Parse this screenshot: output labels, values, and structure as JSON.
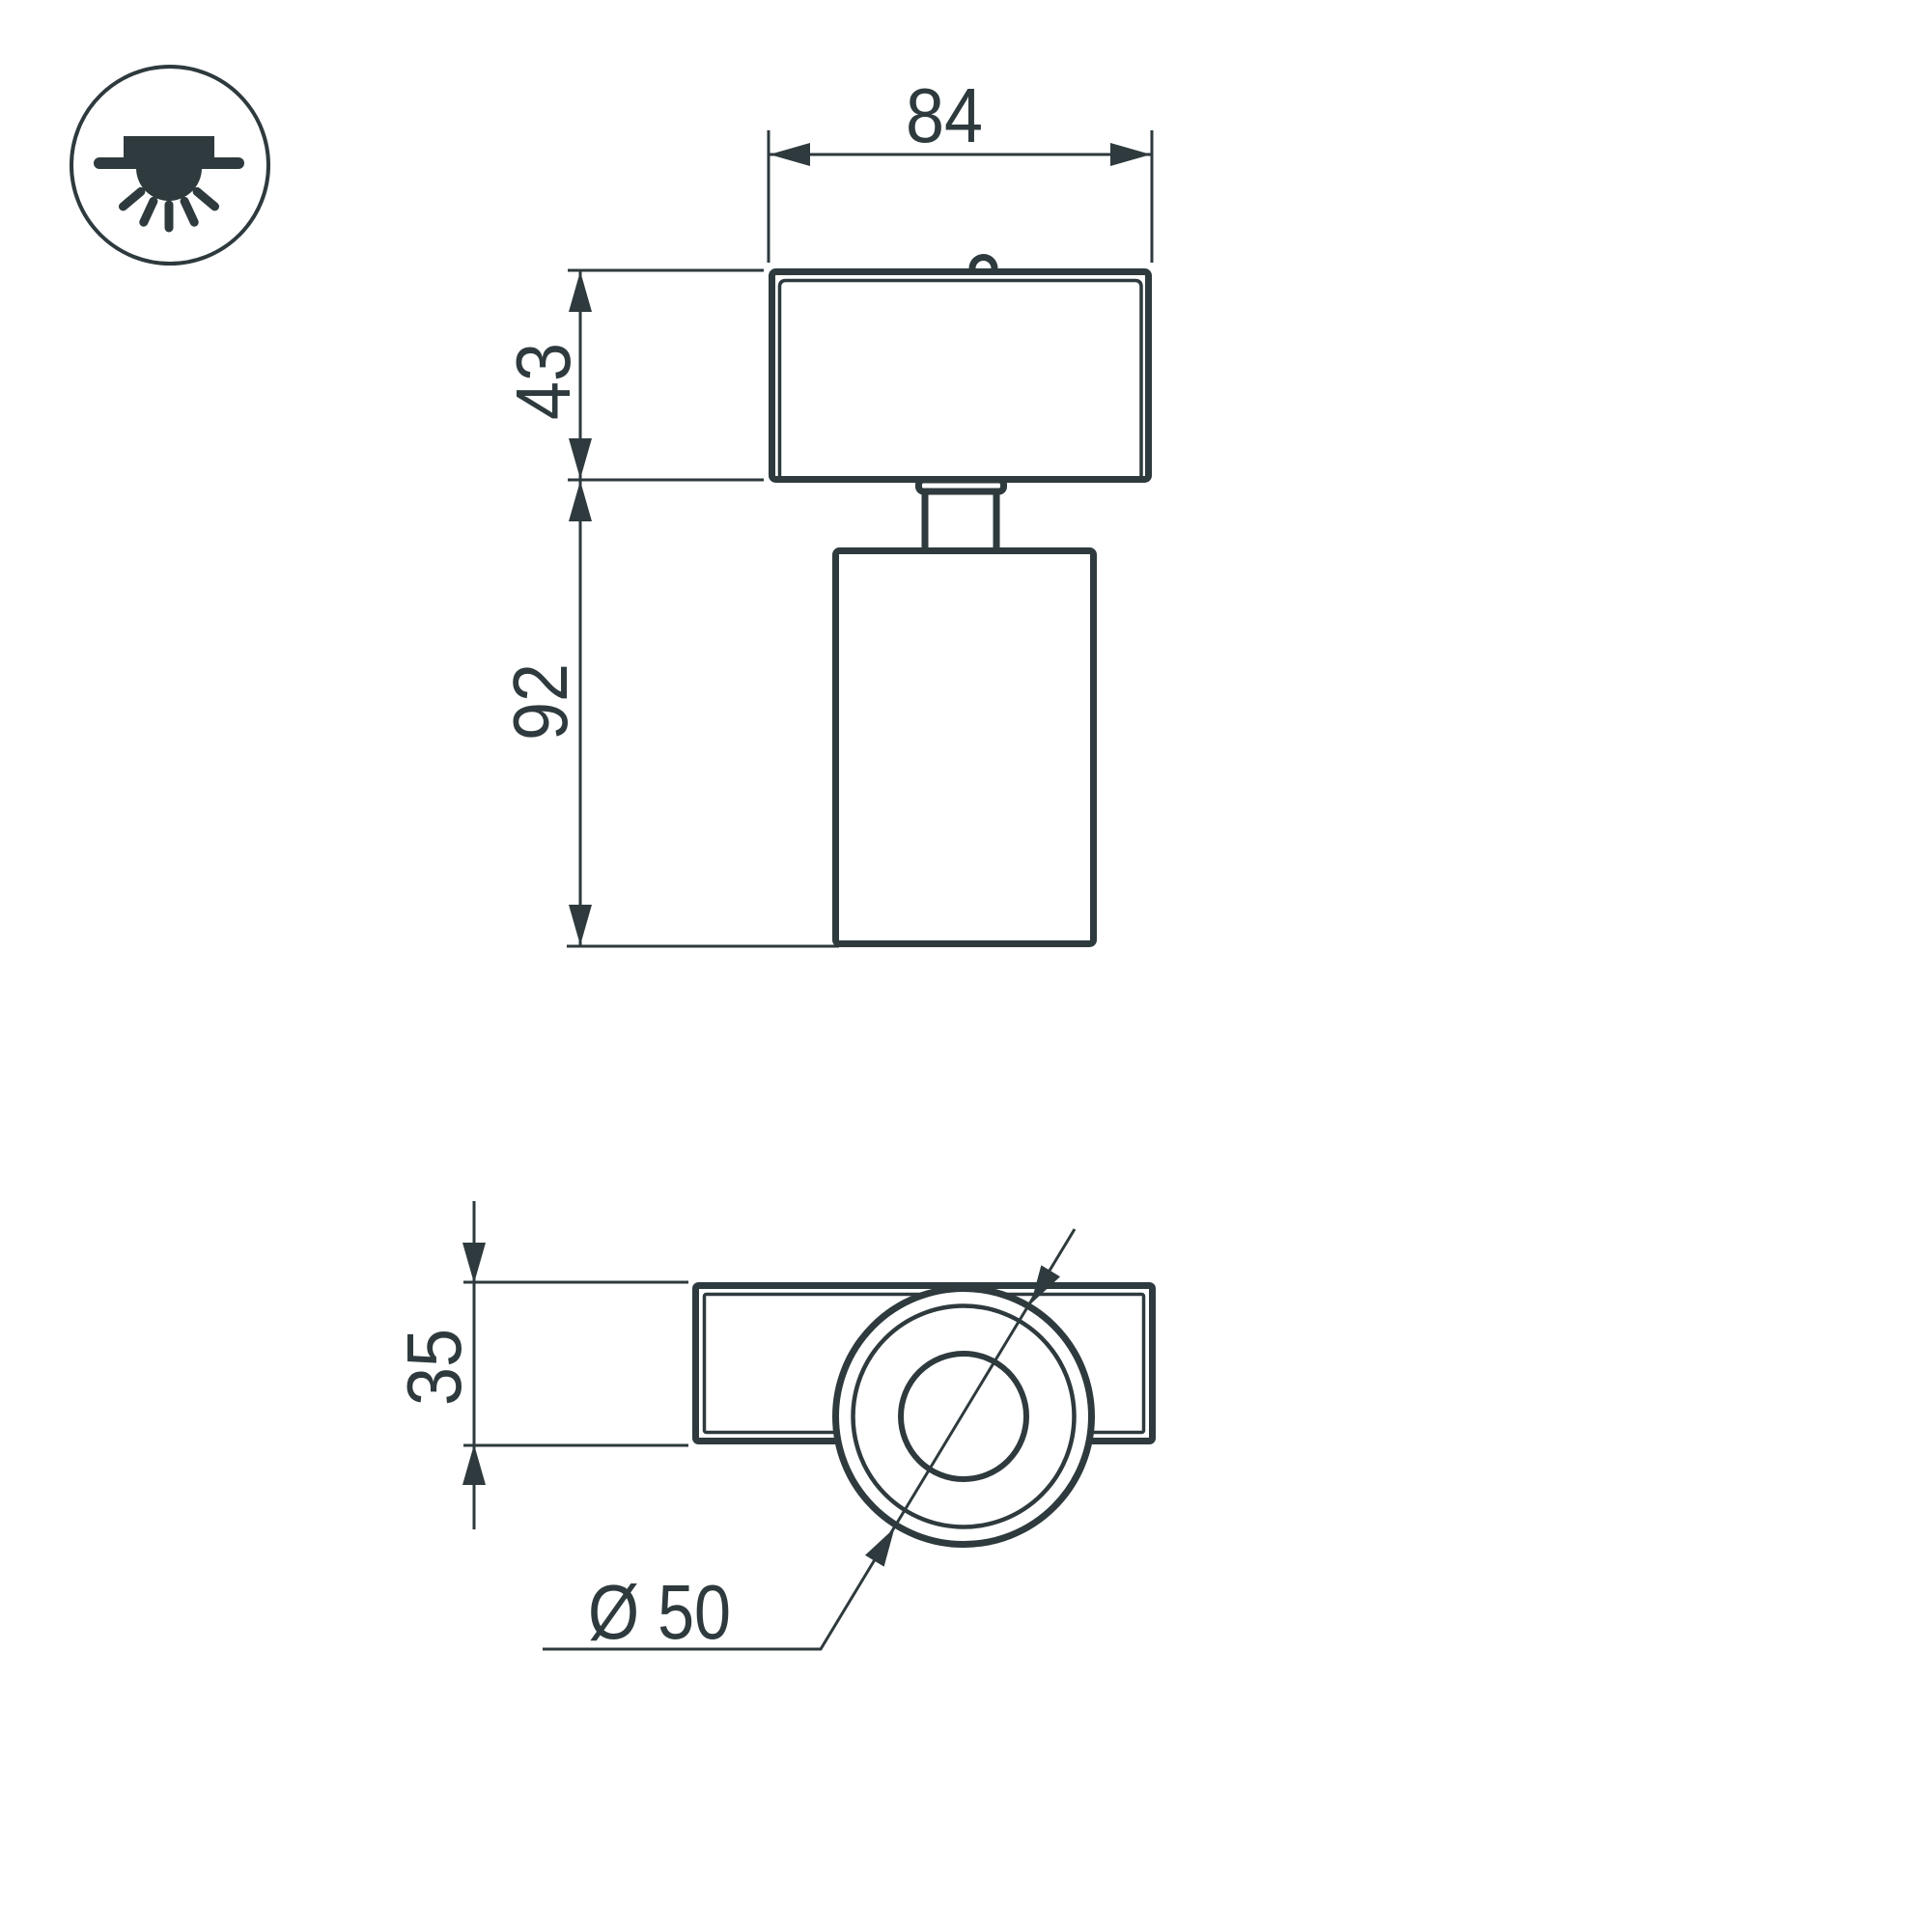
{
  "drawing": {
    "kind": "luminaire-dimension-drawing",
    "colors": {
      "line": "#2e3a3d",
      "background": "#ffffff"
    },
    "mounting_icon": "surface-mounted-ceiling-light",
    "views": [
      "front-view",
      "bottom-view"
    ]
  },
  "dims": {
    "adapter_width": "84",
    "adapter_height": "43",
    "body_height": "92",
    "plate_depth": "35",
    "body_diameter": "Ø 50"
  }
}
